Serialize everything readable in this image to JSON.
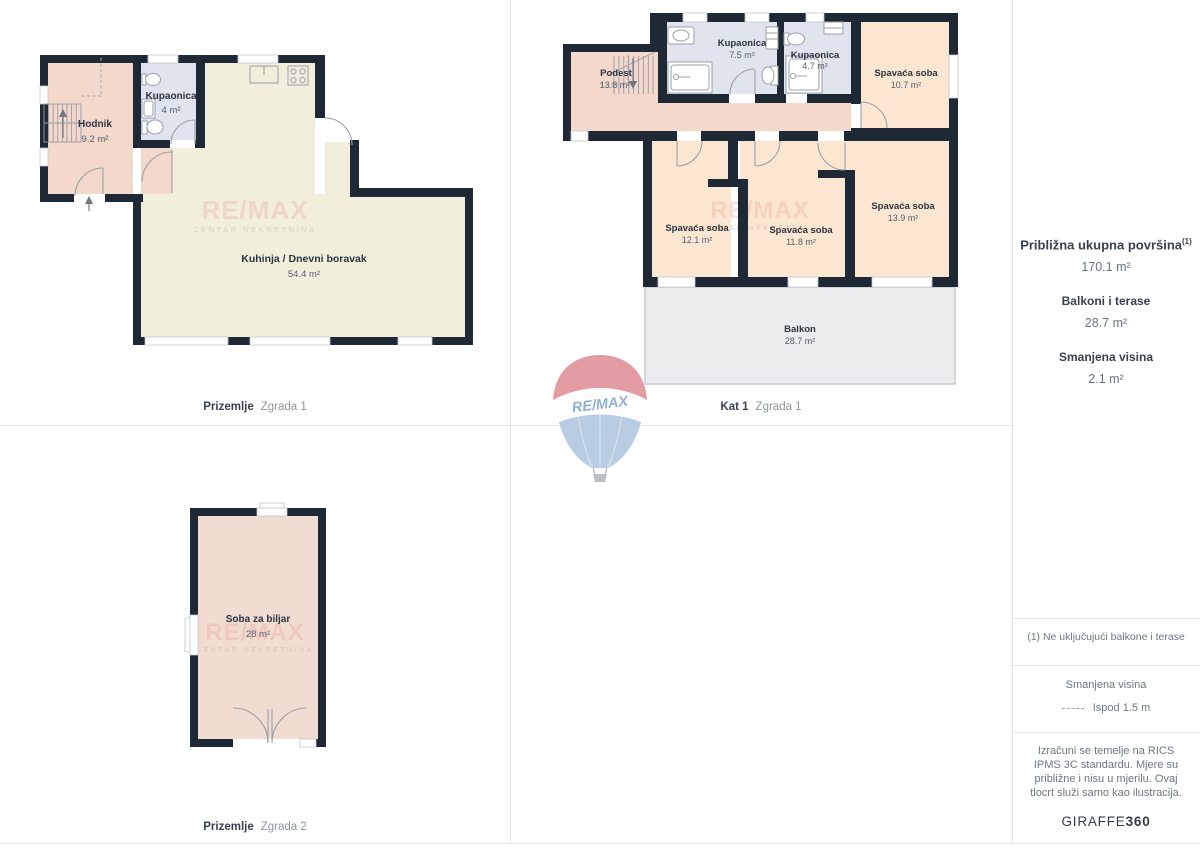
{
  "plans": {
    "plan1": {
      "caption_bold": "Prizemlje",
      "caption_light": "Zgrada 1",
      "rooms": {
        "hodnik": {
          "name": "Hodnik",
          "area": "9.2 m²"
        },
        "kupaonica": {
          "name": "Kupaonica",
          "area": "4 m²"
        },
        "kuhinja": {
          "name": "Kuhinja / Dnevni boravak",
          "area": "54.4 m²"
        }
      }
    },
    "plan2": {
      "caption_bold": "Kat 1",
      "caption_light": "Zgrada 1",
      "rooms": {
        "podest": {
          "name": "Podest",
          "area": "13.8 m²"
        },
        "kupaonica1": {
          "name": "Kupaonica",
          "area": "7.5 m²"
        },
        "kupaonica2": {
          "name": "Kupaonica",
          "area": "4.7 m²"
        },
        "spavaca1": {
          "name": "Spavaća soba",
          "area": "10.7 m²"
        },
        "spavaca2": {
          "name": "Spavaća soba",
          "area": "12.1 m²"
        },
        "spavaca3": {
          "name": "Spavaća soba",
          "area": "11.8 m²"
        },
        "spavaca4": {
          "name": "Spavaća soba",
          "area": "13.9 m²"
        },
        "balkon": {
          "name": "Balkon",
          "area": "28.7 m²"
        }
      }
    },
    "plan3": {
      "caption_bold": "Prizemlje",
      "caption_light": "Zgrada 2",
      "rooms": {
        "biljar": {
          "name": "Soba za biljar",
          "area": "28 m²"
        }
      }
    }
  },
  "sidebar": {
    "total_label": "Približna ukupna površina",
    "total_sup": "(1)",
    "total_value": "170.1 m²",
    "balconies_label": "Balkoni i terase",
    "balconies_value": "28.7 m²",
    "reduced_label": "Smanjena visina",
    "reduced_value": "2.1 m²",
    "footnote": "(1) Ne uključujući balkone i terase",
    "legend_title": "Smanjena visina",
    "legend_text": "Ispod 1.5 m",
    "disclaimer": "Izračuni se temelje na RICS IPMS 3C standardu. Mjere su približne i nisu u mjerilu. Ovaj tlocrt služi samo kao ilustracija.",
    "brand_regular": "GIRAFFE",
    "brand_bold": "360"
  },
  "watermark": {
    "line1": "RE/MAX",
    "line2": "CENTAR NEKRETNINA"
  },
  "logo": {
    "text": "RE/MAX"
  },
  "colors": {
    "wall": "#1f2935",
    "pink": "#f3d8cb",
    "peach": "#fbe7d1",
    "blue": "#dfe4ef",
    "cream": "#f2eedc",
    "grey_balcony": "#ebecee",
    "logo_red": "#e2949c",
    "logo_blue": "#b2c8e1"
  }
}
